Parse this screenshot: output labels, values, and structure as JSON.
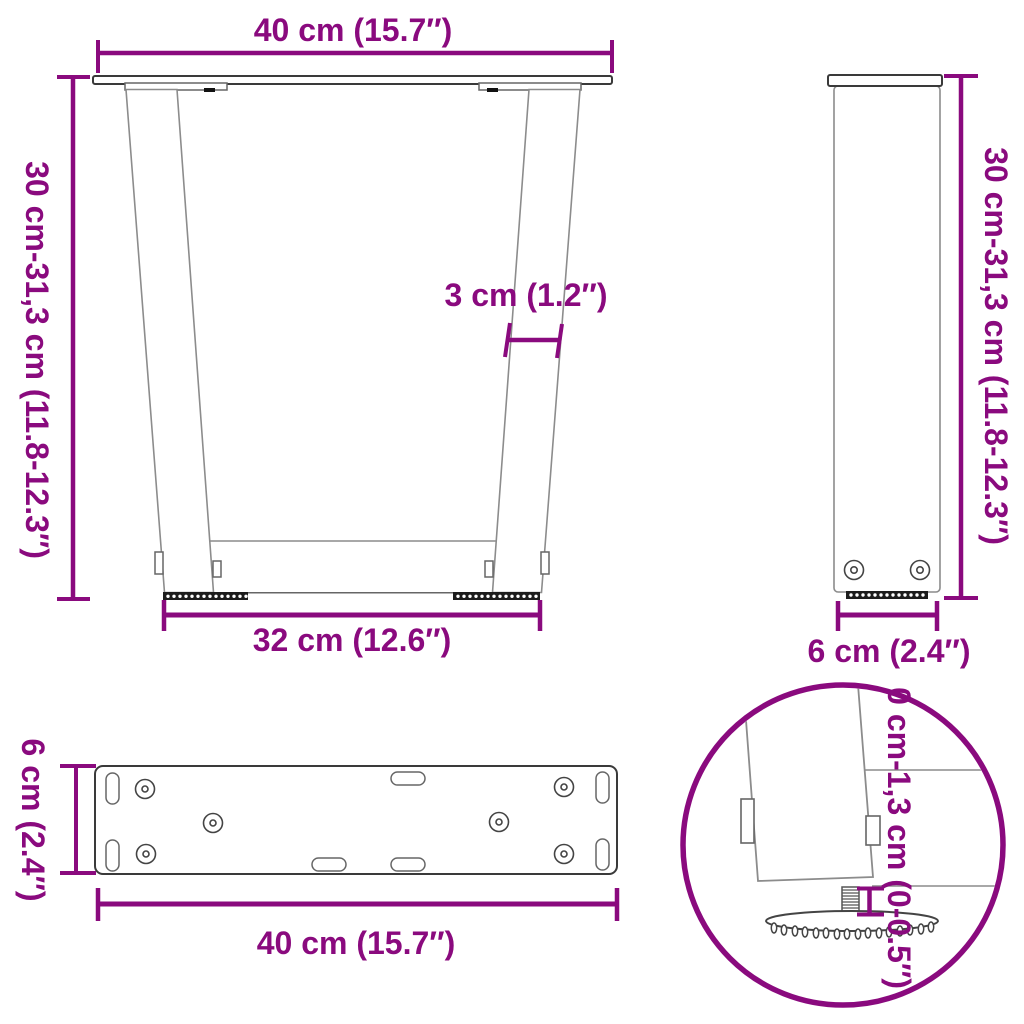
{
  "title": "V-shaped table legs dimension diagram",
  "colors": {
    "accent": "#8A0A7E",
    "line_dark": "#3A3A3A",
    "line_mid": "#666666",
    "line_light": "#8C8C8C",
    "background": "#FFFFFF"
  },
  "views": {
    "front": {
      "name": "front view of V-shaped leg pair",
      "label_top_width": "40 cm (15.7″)",
      "label_height": "30 cm-31,3 cm (11.8-12.3″)",
      "label_leg_thickness": "3 cm (1.2″)",
      "label_bottom_width": "32 cm (12.6″)"
    },
    "side": {
      "name": "side view of leg",
      "label_height": "30 cm-31,3 cm (11.8-12.3″)",
      "label_depth": "6 cm (2.4″)"
    },
    "plate": {
      "name": "top view of mounting plate",
      "label_depth": "6 cm (2.4″)",
      "label_width": "40 cm (15.7″)"
    },
    "detail": {
      "name": "adjustable foot detail circle",
      "label_adjustment": "0 cm-1,3 cm (0-0.5″)"
    }
  }
}
